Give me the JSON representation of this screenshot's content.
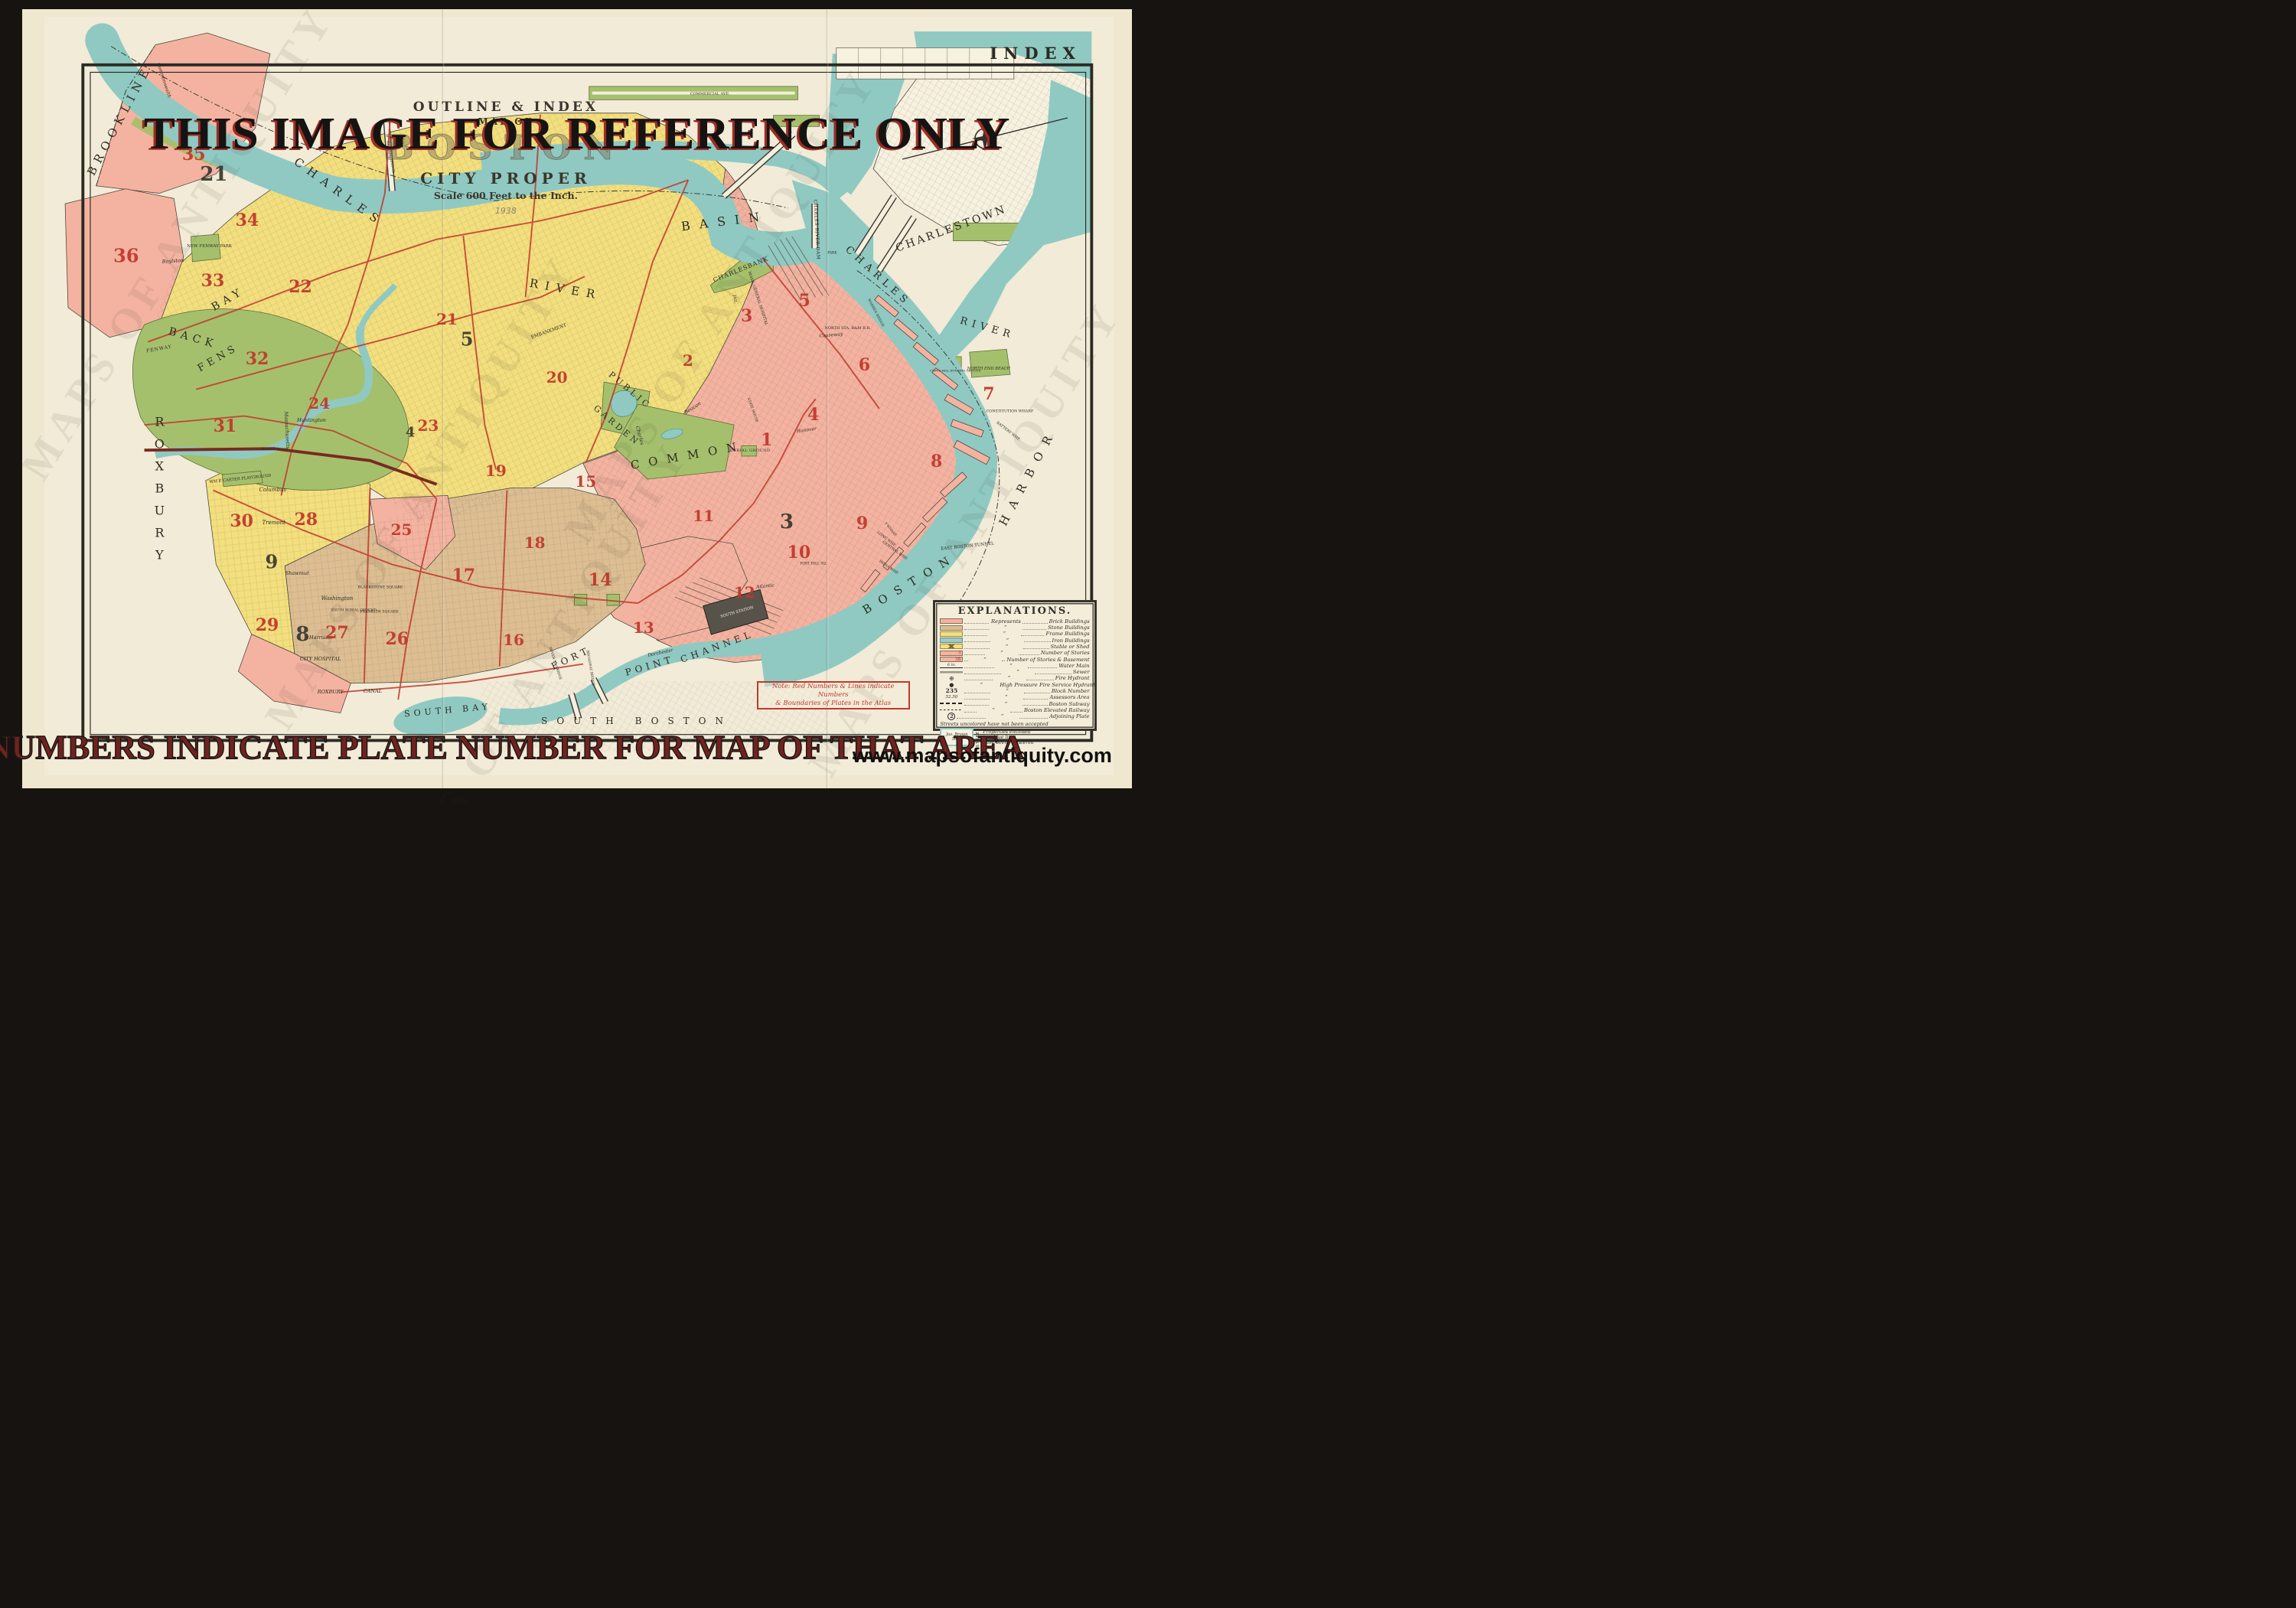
{
  "watermarks": {
    "banner": "THIS IMAGE FOR REFERENCE ONLY",
    "caption": "RED NUMBERS INDICATE PLATE NUMBER FOR MAP OF THAT AREA",
    "url": "www.mapsofantiquity.com",
    "diagonal": "MAPS OF ANTIQUITY"
  },
  "colors": {
    "background": "#171310",
    "paper": "#efe7d0",
    "map_cream": "#f3edda",
    "water": "#8fc9c2",
    "park_green": "#a5c06c",
    "brick_pink": "#f4b3a0",
    "frame_yellow": "#f3df7d",
    "stone_tan": "#ddbe92",
    "plate_red": "#c0392e",
    "ink": "#2e2b24",
    "banner_black": "#151413",
    "banner_red": "#9e2c22",
    "caption_red": "#71221f"
  },
  "map": {
    "index_label": "INDEX",
    "title": {
      "line1": "OUTLINE & INDEX",
      "line2": "MAP OF",
      "line3": "BOSTON",
      "line4": "CITY PROPER",
      "scale": "Scale 600 Feet to the Inch.",
      "year": "1938"
    },
    "note": {
      "line1": "Note: Red Numbers & Lines indicate Numbers",
      "line2": "& Boundaries of Plates in the Atlas"
    },
    "labels": [
      {
        "t": "BROOKLINE",
        "x": 8.8,
        "y": 14.3,
        "r": -62,
        "s": 15,
        "ls": 7
      },
      {
        "t": "CHARLES",
        "x": 28.6,
        "y": 23.5,
        "r": 36,
        "s": 15,
        "ls": 9
      },
      {
        "t": "RIVER",
        "x": 49.0,
        "y": 36.0,
        "r": 10,
        "s": 15,
        "ls": 9
      },
      {
        "t": "BASIN",
        "x": 63.3,
        "y": 27.2,
        "r": -7,
        "s": 16,
        "ls": 12
      },
      {
        "t": "CHARLESBANK",
        "x": 64.8,
        "y": 33.4,
        "r": -22,
        "s": 8,
        "ls": 1
      },
      {
        "t": "CHARLES RIVER DAM",
        "x": 71.6,
        "y": 28.3,
        "r": 87,
        "s": 6,
        "ls": 0.5
      },
      {
        "t": "CHARLESTOWN",
        "x": 83.7,
        "y": 28.2,
        "r": -20,
        "s": 14,
        "ls": 3
      },
      {
        "t": "CHARLES",
        "x": 77.1,
        "y": 34.3,
        "r": 42,
        "s": 13,
        "ls": 6
      },
      {
        "t": "RIVER",
        "x": 87.0,
        "y": 41.0,
        "r": 16,
        "s": 13,
        "ls": 6
      },
      {
        "t": "PUBLIC",
        "x": 54.8,
        "y": 48.9,
        "r": 40,
        "s": 11,
        "ls": 4
      },
      {
        "t": "GARDEN",
        "x": 53.6,
        "y": 53.5,
        "r": 40,
        "s": 11,
        "ls": 4
      },
      {
        "t": "COMMON",
        "x": 60.0,
        "y": 57.3,
        "r": -10,
        "s": 15,
        "ls": 12
      },
      {
        "t": "BURIAL GROUND",
        "x": 65.6,
        "y": 56.7,
        "s": 5,
        "ls": 0.5
      },
      {
        "t": "ROXBURY",
        "x": 12.4,
        "y": 62.0,
        "s": 16,
        "v": true
      },
      {
        "t": "BACK",
        "x": 15.4,
        "y": 42.3,
        "r": 16,
        "s": 14,
        "ls": 6
      },
      {
        "t": "BAY",
        "x": 18.6,
        "y": 37.3,
        "r": -30,
        "s": 14,
        "ls": 6
      },
      {
        "t": "FENS",
        "x": 17.7,
        "y": 44.8,
        "r": -30,
        "s": 13,
        "ls": 5
      },
      {
        "t": "FENWAY",
        "x": 12.4,
        "y": 43.6,
        "r": -10,
        "s": 6,
        "ls": 1
      },
      {
        "t": "NEW FENWAY PARK",
        "x": 16.9,
        "y": 30.5,
        "s": 5.5
      },
      {
        "t": "WM E CARTER PLAYGROUND",
        "x": 19.7,
        "y": 60.3,
        "r": -6,
        "s": 5.2
      },
      {
        "t": "FORT",
        "x": 49.5,
        "y": 83.3,
        "r": -25,
        "s": 12,
        "ls": 5
      },
      {
        "t": "POINT",
        "x": 56.6,
        "y": 84.3,
        "r": -16,
        "s": 12,
        "ls": 5
      },
      {
        "t": "CHANNEL",
        "x": 62.6,
        "y": 81.8,
        "r": -20,
        "s": 12,
        "ls": 5
      },
      {
        "t": "SOUTH BAY",
        "x": 38.4,
        "y": 90.0,
        "r": -5,
        "s": 11,
        "ls": 5
      },
      {
        "t": "SOUTH BOSTON",
        "x": 55.4,
        "y": 91.4,
        "s": 12,
        "ls": 12
      },
      {
        "t": "BOSTON",
        "x": 80.0,
        "y": 73.7,
        "r": -31,
        "s": 15,
        "ls": 12
      },
      {
        "t": "HARBOR",
        "x": 90.6,
        "y": 60.0,
        "r": -62,
        "s": 15,
        "ls": 12
      },
      {
        "t": "EAST BOSTON TUNNEL",
        "x": 85.2,
        "y": 69.0,
        "r": -6,
        "s": 5.5
      },
      {
        "t": "SOUTH STATION",
        "x": 64.4,
        "y": 77.4,
        "r": -16,
        "s": 5,
        "cl": "white"
      },
      {
        "t": "NORTH STA. B&M R.R.",
        "x": 74.4,
        "y": 41.0,
        "s": 5
      },
      {
        "t": "MASS. GENERAL HOSPITAL",
        "x": 66.3,
        "y": 37.2,
        "r": 72,
        "s": 5
      },
      {
        "t": "JAIL",
        "x": 64.2,
        "y": 37.3,
        "r": 80,
        "s": 5
      },
      {
        "t": "CITY HOSPITAL",
        "x": 26.9,
        "y": 83.4,
        "s": 6.5,
        "it": true
      },
      {
        "t": "BLACKSTONE SQUARE",
        "x": 32.3,
        "y": 74.3,
        "s": 4.8
      },
      {
        "t": "FRANKLIN SQUARE",
        "x": 32.2,
        "y": 77.4,
        "s": 4.8
      },
      {
        "t": "SOUTH BURIAL GROUND",
        "x": 29.9,
        "y": 77.2,
        "s": 4.4
      },
      {
        "t": "ROXBURY",
        "x": 27.8,
        "y": 87.6,
        "s": 6.5,
        "it": true
      },
      {
        "t": "CANAL",
        "x": 31.6,
        "y": 87.5,
        "s": 6.5,
        "it": true
      },
      {
        "t": "NORTH END BEACH",
        "x": 87.1,
        "y": 46.2,
        "s": 5.2,
        "it": true
      },
      {
        "t": "CONSTITUTION WHARF",
        "x": 89.0,
        "y": 51.7,
        "s": 4.8
      },
      {
        "t": "BATTERY WHF.",
        "x": 88.8,
        "y": 54.2,
        "r": 38,
        "s": 4.8
      },
      {
        "t": "LONG WHF.",
        "x": 77.9,
        "y": 68.1,
        "r": 38,
        "s": 4.8
      },
      {
        "t": "CENTRAL WHF.",
        "x": 78.6,
        "y": 69.6,
        "r": 36,
        "s": 4.8
      },
      {
        "t": "INDIA WHF.",
        "x": 78.1,
        "y": 71.7,
        "r": 35,
        "s": 4.8
      },
      {
        "t": "T WHARF",
        "x": 78.2,
        "y": 66.8,
        "r": 50,
        "s": 4.4
      },
      {
        "t": "COPPS HILL BURYING GROUND",
        "x": 84.1,
        "y": 46.4,
        "s": 3.9
      },
      {
        "t": "COMMERCIAL AVE.",
        "x": 62.0,
        "y": 10.9,
        "s": 5
      },
      {
        "t": "EMBANKMENT",
        "x": 47.5,
        "y": 41.4,
        "r": -20,
        "s": 6
      },
      {
        "t": "STATE HOUSE",
        "x": 65.8,
        "y": 51.5,
        "r": 70,
        "s": 4.4
      },
      {
        "t": "FORT HILL SQ.",
        "x": 71.3,
        "y": 71.2,
        "s": 4.4
      },
      {
        "t": "PARK",
        "x": 73.0,
        "y": 31.4,
        "s": 4.4
      },
      {
        "t": "Washington",
        "x": 28.4,
        "y": 75.6,
        "s": 7,
        "it": true
      },
      {
        "t": "Harrison",
        "x": 26.9,
        "y": 80.7,
        "s": 6.5,
        "it": true
      },
      {
        "t": "Shawmut",
        "x": 24.8,
        "y": 72.4,
        "s": 6.5,
        "it": true
      },
      {
        "t": "Tremont",
        "x": 22.7,
        "y": 65.9,
        "s": 7,
        "it": true
      },
      {
        "t": "Columbus",
        "x": 22.6,
        "y": 61.7,
        "s": 7,
        "it": true
      },
      {
        "t": "Huntington",
        "x": 26.1,
        "y": 52.8,
        "s": 6.5,
        "it": true
      },
      {
        "t": "Massachusetts",
        "x": 23.9,
        "y": 54.0,
        "r": 87,
        "s": 6.5,
        "it": true
      },
      {
        "t": "Boston Arena",
        "x": 22.8,
        "y": 56.5,
        "s": 5,
        "it": true
      },
      {
        "t": "Beacon",
        "x": 60.4,
        "y": 51.2,
        "r": -33,
        "s": 6.5,
        "it": true
      },
      {
        "t": "Charles",
        "x": 55.7,
        "y": 54.7,
        "r": 75,
        "s": 6.5,
        "it": true
      },
      {
        "t": "Hanover",
        "x": 70.7,
        "y": 54.0,
        "r": -8,
        "s": 6,
        "it": true
      },
      {
        "t": "Causeway",
        "x": 72.9,
        "y": 41.9,
        "r": -5,
        "s": 6,
        "it": true
      },
      {
        "t": "Atlantic",
        "x": 67.0,
        "y": 74.1,
        "r": -6,
        "s": 6,
        "it": true
      },
      {
        "t": "Dorchester",
        "x": 57.5,
        "y": 82.6,
        "r": -12,
        "s": 6,
        "it": true
      },
      {
        "t": "Boylston",
        "x": 13.6,
        "y": 32.3,
        "r": -4,
        "s": 6.5,
        "it": true
      },
      {
        "t": "Commonwealth",
        "x": 12.8,
        "y": 9.2,
        "r": 72,
        "s": 6,
        "it": true
      },
      {
        "t": "WARREN BRIDGE",
        "x": 76.9,
        "y": 39.0,
        "r": 62,
        "s": 4.4
      },
      {
        "t": "BROADWAY BRIDGE",
        "x": 51.2,
        "y": 84.6,
        "r": 80,
        "s": 4.4
      },
      {
        "t": "DOVER ST. BRIDGE",
        "x": 48.0,
        "y": 84.0,
        "r": 72,
        "s": 4.4
      },
      {
        "t": "HARVARD BRIDGE",
        "x": 33.2,
        "y": 19.0,
        "r": 80,
        "s": 4.4
      }
    ],
    "plate_numbers": [
      {
        "n": "35",
        "x": 15.5,
        "y": 18.7,
        "s": 22,
        "c": "red"
      },
      {
        "n": "21",
        "x": 17.3,
        "y": 21.3,
        "s": 26,
        "c": "black"
      },
      {
        "n": "36",
        "x": 9.4,
        "y": 31.7,
        "s": 24,
        "c": "red"
      },
      {
        "n": "34",
        "x": 20.3,
        "y": 27.1,
        "s": 22,
        "c": "red"
      },
      {
        "n": "33",
        "x": 17.2,
        "y": 34.9,
        "s": 22,
        "c": "red"
      },
      {
        "n": "22",
        "x": 25.1,
        "y": 35.7,
        "s": 22,
        "c": "red"
      },
      {
        "n": "21",
        "x": 38.3,
        "y": 39.8,
        "s": 20,
        "c": "red"
      },
      {
        "n": "5",
        "x": 40.1,
        "y": 42.4,
        "s": 24,
        "c": "black"
      },
      {
        "n": "2",
        "x": 60.0,
        "y": 45.1,
        "s": 20,
        "c": "red"
      },
      {
        "n": "32",
        "x": 21.2,
        "y": 44.9,
        "s": 22,
        "c": "red"
      },
      {
        "n": "24",
        "x": 26.8,
        "y": 50.6,
        "s": 20,
        "c": "red"
      },
      {
        "n": "31",
        "x": 18.3,
        "y": 53.6,
        "s": 22,
        "c": "red"
      },
      {
        "n": "23",
        "x": 36.6,
        "y": 53.5,
        "s": 20,
        "c": "red"
      },
      {
        "n": "4",
        "x": 35.0,
        "y": 54.3,
        "s": 18,
        "c": "black"
      },
      {
        "n": "19",
        "x": 42.7,
        "y": 59.2,
        "s": 20,
        "c": "red"
      },
      {
        "n": "20",
        "x": 48.2,
        "y": 47.3,
        "s": 20,
        "c": "red"
      },
      {
        "n": "15",
        "x": 50.8,
        "y": 60.6,
        "s": 20,
        "c": "red"
      },
      {
        "n": "30",
        "x": 19.8,
        "y": 65.7,
        "s": 22,
        "c": "red"
      },
      {
        "n": "28",
        "x": 25.6,
        "y": 65.5,
        "s": 22,
        "c": "red"
      },
      {
        "n": "25",
        "x": 34.2,
        "y": 66.8,
        "s": 20,
        "c": "red"
      },
      {
        "n": "9",
        "x": 22.5,
        "y": 70.9,
        "s": 24,
        "c": "black"
      },
      {
        "n": "18",
        "x": 46.2,
        "y": 68.5,
        "s": 20,
        "c": "red"
      },
      {
        "n": "17",
        "x": 39.8,
        "y": 72.7,
        "s": 22,
        "c": "red"
      },
      {
        "n": "14",
        "x": 52.1,
        "y": 73.3,
        "s": 22,
        "c": "red"
      },
      {
        "n": "29",
        "x": 22.1,
        "y": 79.1,
        "s": 22,
        "c": "red"
      },
      {
        "n": "8",
        "x": 25.3,
        "y": 80.3,
        "s": 26,
        "c": "black"
      },
      {
        "n": "27",
        "x": 28.4,
        "y": 80.1,
        "s": 22,
        "c": "red"
      },
      {
        "n": "26",
        "x": 33.8,
        "y": 80.8,
        "s": 22,
        "c": "red"
      },
      {
        "n": "16",
        "x": 44.3,
        "y": 80.9,
        "s": 20,
        "c": "red"
      },
      {
        "n": "12",
        "x": 65.1,
        "y": 74.9,
        "s": 20,
        "c": "red"
      },
      {
        "n": "13",
        "x": 56.0,
        "y": 79.4,
        "s": 20,
        "c": "red"
      },
      {
        "n": "11",
        "x": 61.4,
        "y": 65.0,
        "s": 20,
        "c": "red"
      },
      {
        "n": "10",
        "x": 70.0,
        "y": 69.8,
        "s": 22,
        "c": "red"
      },
      {
        "n": "3",
        "x": 68.9,
        "y": 65.8,
        "s": 26,
        "c": "black"
      },
      {
        "n": "1",
        "x": 67.1,
        "y": 55.3,
        "s": 22,
        "c": "red"
      },
      {
        "n": "4",
        "x": 71.3,
        "y": 52.1,
        "s": 22,
        "c": "red"
      },
      {
        "n": "3",
        "x": 65.3,
        "y": 39.4,
        "s": 22,
        "c": "red"
      },
      {
        "n": "5",
        "x": 70.5,
        "y": 37.5,
        "s": 22,
        "c": "red"
      },
      {
        "n": "6",
        "x": 75.9,
        "y": 45.7,
        "s": 22,
        "c": "red"
      },
      {
        "n": "7",
        "x": 87.1,
        "y": 49.4,
        "s": 22,
        "c": "red"
      },
      {
        "n": "8",
        "x": 82.4,
        "y": 58.1,
        "s": 22,
        "c": "red"
      },
      {
        "n": "9",
        "x": 75.7,
        "y": 66.0,
        "s": 22,
        "c": "red"
      }
    ],
    "legend": {
      "title": "EXPLANATIONS.",
      "represents": "Represents",
      "ditto": "”",
      "rows": [
        {
          "sw": "brick",
          "label": "Brick Buildings"
        },
        {
          "sw": "stone",
          "label": "Stone Buildings"
        },
        {
          "sw": "frame",
          "label": "Frame Buildings"
        },
        {
          "sw": "iron",
          "label": "Iron Buildings"
        },
        {
          "sw": "shed",
          "label": "Stable or Shed"
        },
        {
          "sw": "stories",
          "mark": "3",
          "label": "Number of Stories"
        },
        {
          "sw": "storiesb",
          "mark": "3B",
          "label": "Number of Stories & Basement"
        },
        {
          "sw": "watermain",
          "mark": "6 in.",
          "label": "Water Main"
        },
        {
          "sw": "sewer",
          "label": "Sewer"
        },
        {
          "sw": "hydrant",
          "mark": "⊕",
          "label": "Fire Hydrant"
        },
        {
          "sw": "hphydrant",
          "mark": "●",
          "label": "High Pressure Fire Service Hydrant"
        },
        {
          "sw": "block",
          "mark": "235",
          "label": "Block Number"
        },
        {
          "sw": "assessors",
          "mark": "52.50",
          "label": "Assessors Area"
        },
        {
          "sw": "subway",
          "label": "Boston Subway"
        },
        {
          "sw": "elevated",
          "label": "Boston Elevated Railway"
        },
        {
          "sw": "adjplate",
          "mark": "2",
          "label": "Adjoining Plate"
        }
      ],
      "note_uncolored": "Streets uncolored have not been accepted",
      "registered_note": [
        "Properties enclosed",
        "in a blue line",
        "have been registered"
      ],
      "sample_owner": "Jas. Brown",
      "sample_value": "5000",
      "sample_street": "STREET"
    }
  }
}
